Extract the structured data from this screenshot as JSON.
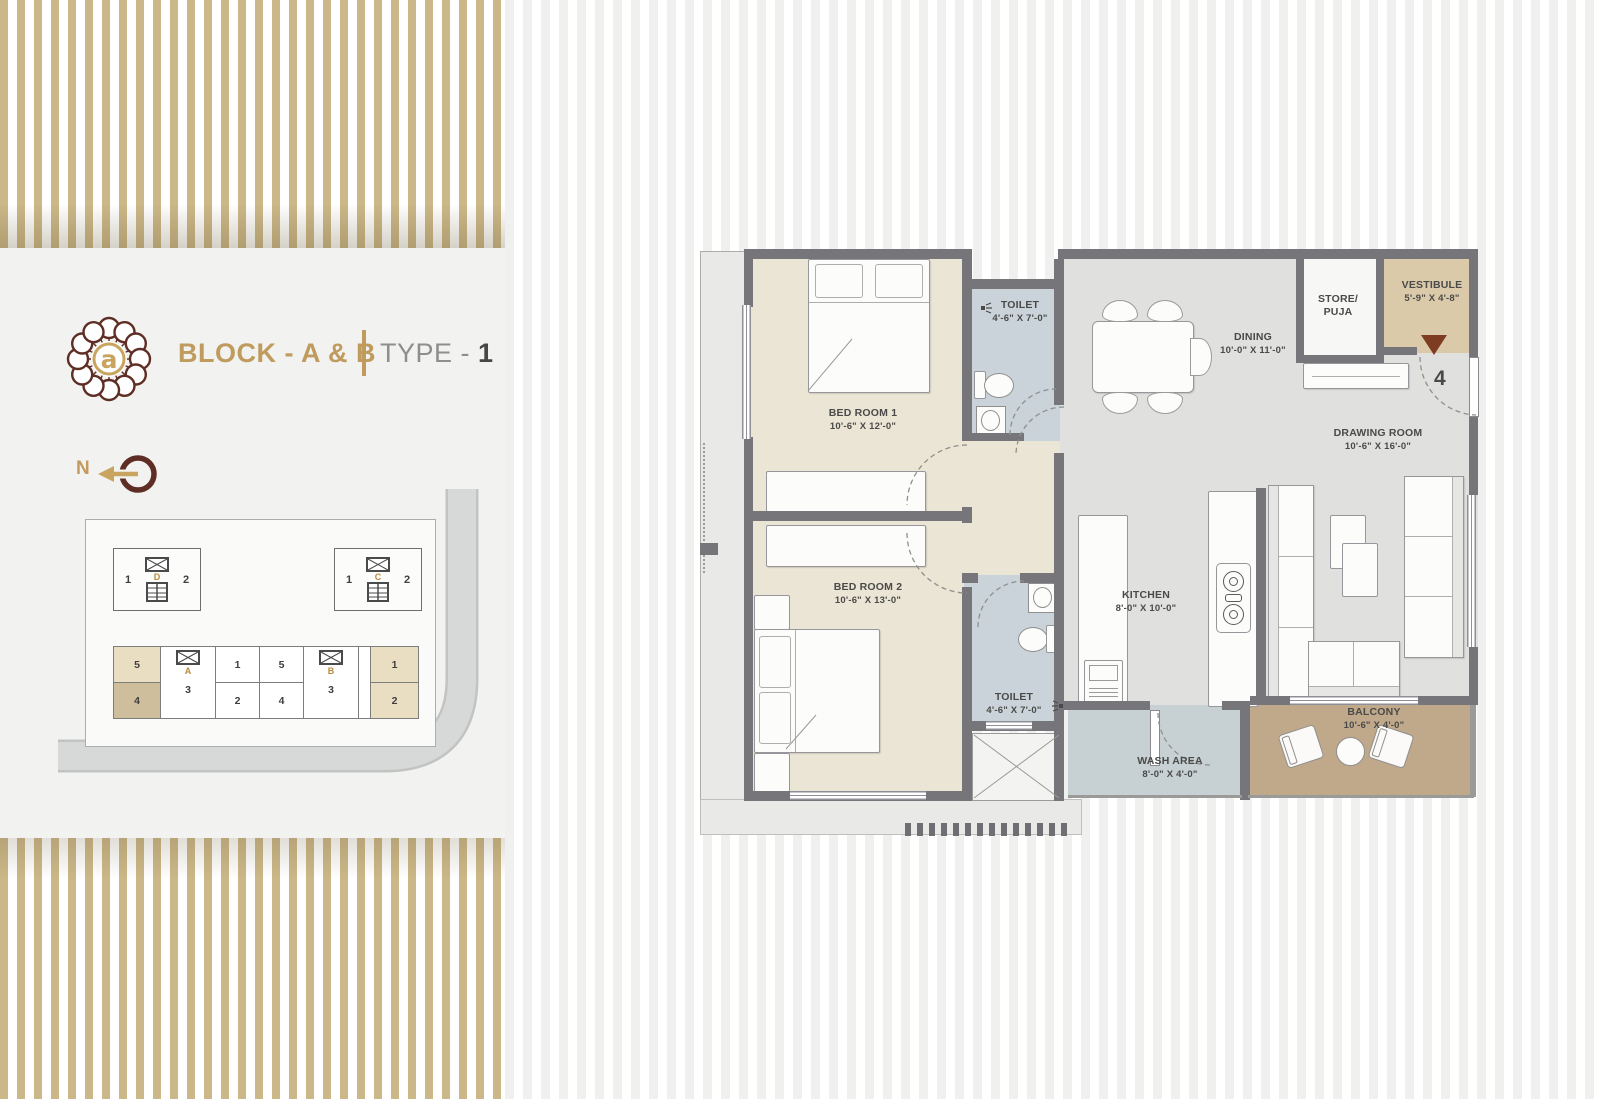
{
  "header": {
    "logo_letter": "a",
    "block_title": "BLOCK - A & B",
    "type_label": "TYPE - ",
    "type_value": "1"
  },
  "compass": {
    "north_label": "N"
  },
  "site_plan": {
    "block_d": {
      "letter": "D",
      "unit_left": "1",
      "unit_right": "2"
    },
    "block_c": {
      "letter": "C",
      "unit_left": "1",
      "unit_right": "2"
    },
    "strip": {
      "left_top": "5",
      "left_bottom": "4",
      "core_a_letter": "A",
      "core_a_unit": "3",
      "mid1_top": "1",
      "mid1_bottom": "2",
      "mid2_top": "5",
      "mid2_bottom": "4",
      "core_b_letter": "B",
      "core_b_unit": "3",
      "right_top": "1",
      "right_bottom": "2"
    }
  },
  "floorplan": {
    "unit_number": "4",
    "rooms": {
      "bedroom1": {
        "name": "BED ROOM 1",
        "dim": "10'-6\" X 12'-0\""
      },
      "toilet1": {
        "name": "TOILET",
        "dim": "4'-6\" X 7'-0\""
      },
      "dining": {
        "name": "DINING",
        "dim": "10'-0\" X 11'-0\""
      },
      "store": {
        "name_line1": "STORE/",
        "name_line2": "PUJA"
      },
      "vestibule": {
        "name": "VESTIBULE",
        "dim": "5'-9\" X 4'-8\""
      },
      "drawing_room": {
        "name": "DRAWING ROOM",
        "dim": "10'-6\" X 16'-0\""
      },
      "bedroom2": {
        "name": "BED ROOM 2",
        "dim": "10'-6\" X 13'-0\""
      },
      "toilet2": {
        "name": "TOILET",
        "dim": "4'-6\" X 7'-0\""
      },
      "kitchen": {
        "name": "KITCHEN",
        "dim": "8'-0\" X 10'-0\""
      },
      "wash_area": {
        "name": "WASH AREA",
        "dim": "8'-0\" X 4'-0\""
      },
      "balcony": {
        "name": "BALCONY",
        "dim": "10'-6\" X 4'-0\""
      }
    }
  },
  "colors": {
    "accent_gold": "#BF9B5E",
    "logo_maroon": "#5E2D24",
    "wall_gray": "#76767A",
    "bedroom_floor": "#EBE5D5",
    "toilet_floor": "#C9D3D9",
    "living_floor": "#E0E1DE",
    "wash_floor": "#C7D0D3",
    "balcony_floor": "#C0A88B",
    "vestibule_floor": "#DACAAA",
    "stripe_tan": "#CBB787",
    "unit_highlight": "#E9DEC2",
    "unit_highlight_dark": "#CFBE9B",
    "entry_arrow": "#7E3C22"
  }
}
